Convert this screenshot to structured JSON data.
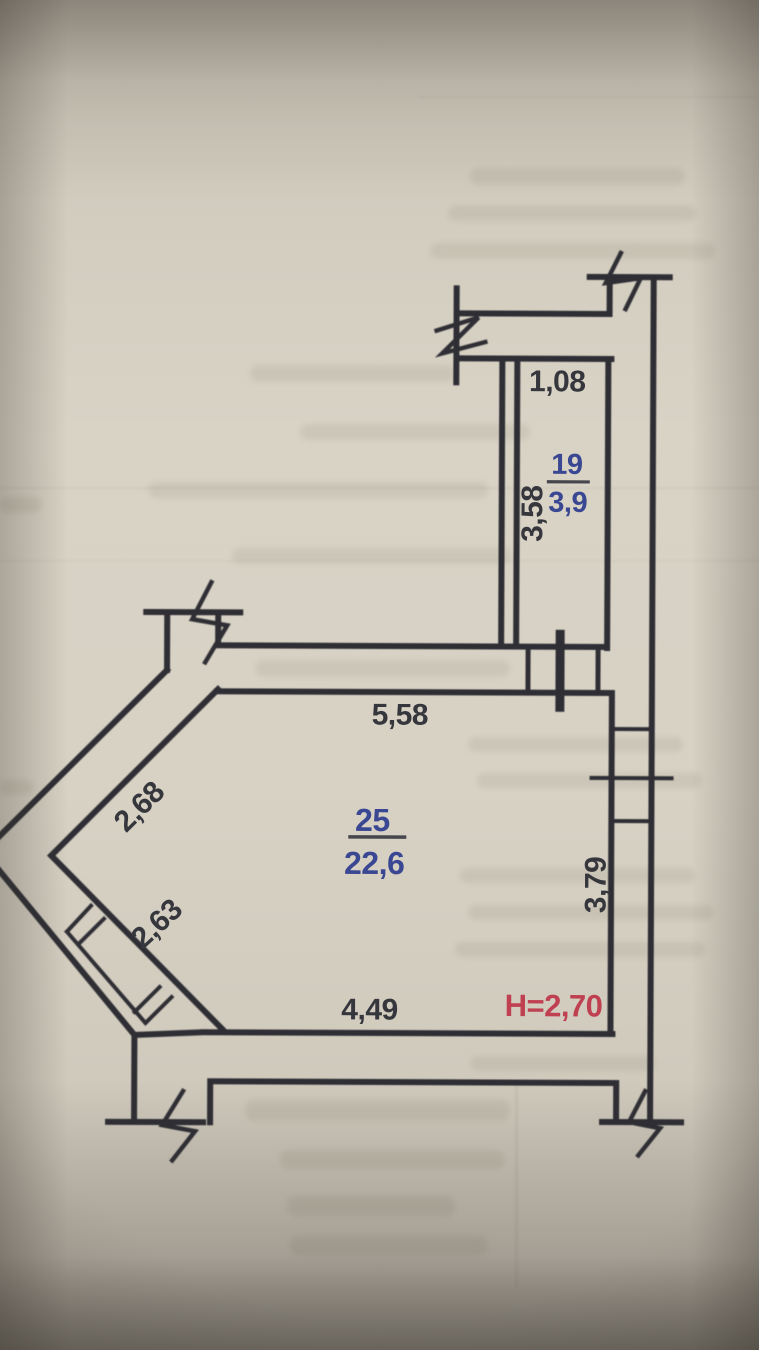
{
  "plan": {
    "rooms": [
      {
        "number": "19",
        "area": "3,9"
      },
      {
        "number": "25",
        "area": "22,6"
      }
    ],
    "ceiling_height_note": "H=2,70",
    "dimensions": {
      "room19_width": "1,08",
      "room19_depth": "3,58",
      "room25_top": "5,58",
      "room25_diagonal_upper": "2,68",
      "room25_diagonal_lower": "2,63",
      "room25_bottom": "4,49",
      "room25_right": "3,79"
    },
    "colors": {
      "ink": "#2e2e34",
      "room_label_blue": "#3a4792",
      "height_note_red": "#bf4051",
      "paper": "#d8d2c5"
    }
  }
}
